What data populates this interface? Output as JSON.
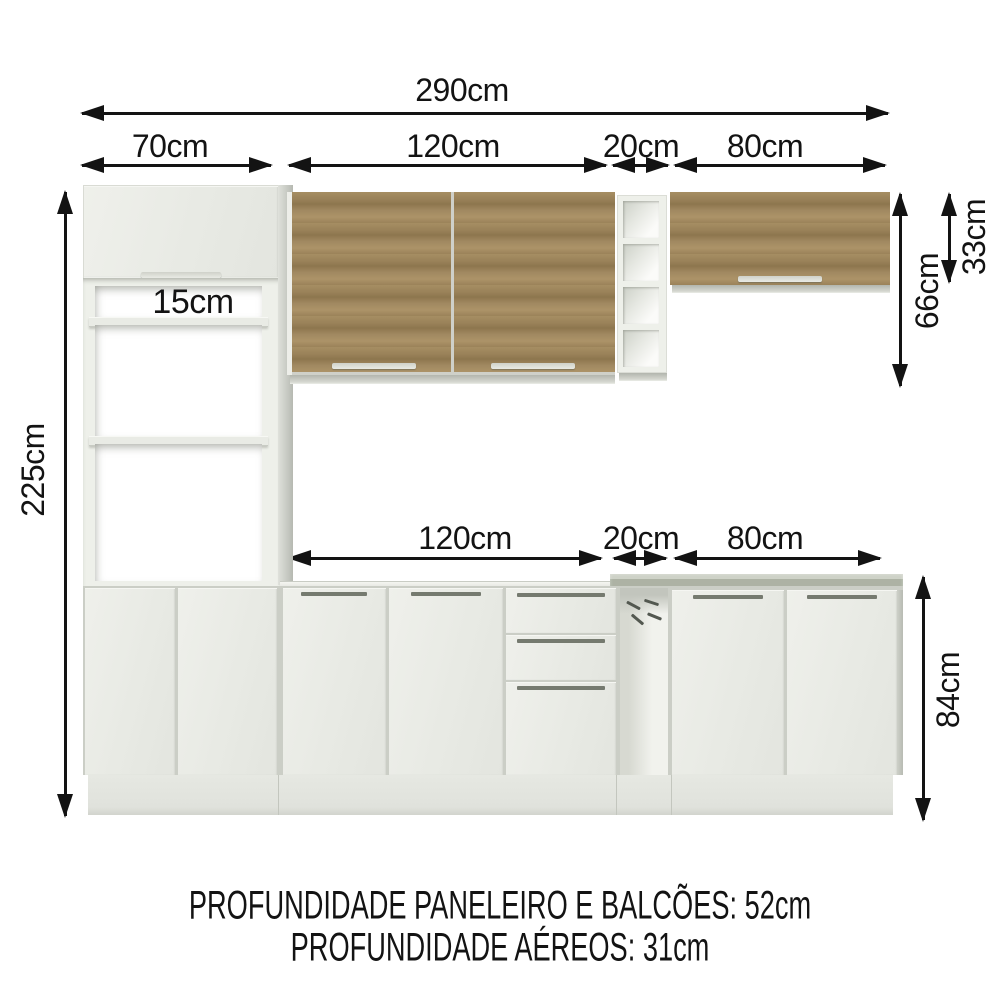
{
  "labels": {
    "total_width": "290cm",
    "top_paneleiro_width": "70cm",
    "top_aereo_width": "120cm",
    "top_nicho_width": "20cm",
    "top_aereo_right_width": "80cm",
    "mid_balcao_width": "120cm",
    "mid_nicho_width": "20cm",
    "mid_balcao_right_width": "80cm",
    "total_height": "225cm",
    "niche_gap_top": "15cm",
    "niche_gap_middle": "37cm",
    "niche_gap_bottom": "54cm",
    "aereo_total_height": "66cm",
    "aereo_door_height": "33cm",
    "balcao_height": "84cm"
  },
  "footer": {
    "line1": "PROFUNDIDADE PANELEIRO E BALCÕES: 52cm",
    "line2": "PROFUNDIDADE AÉREOS: 31cm"
  },
  "colors": {
    "wood": "#9a8259",
    "cabinet_white": "#ecede8",
    "countertop_granite": "#a8ad9f",
    "text": "#131313"
  }
}
